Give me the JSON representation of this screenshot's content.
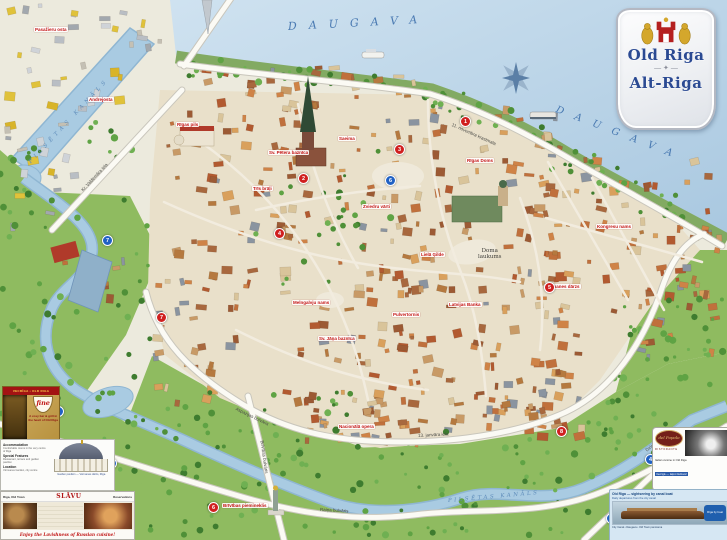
{
  "cartouche": {
    "title_en": "Old Riga",
    "title_de": "Alt-Riga",
    "ornament": "— ✦ —"
  },
  "water_labels": [
    {
      "name": "daugava-label-top",
      "text": "DAUGAVA",
      "x": 288,
      "y": 20,
      "rot": -3,
      "size": 11,
      "ls": 12,
      "color": "#4a7ab2"
    },
    {
      "name": "daugava-label-right",
      "text": "DAUGAVA",
      "x": 556,
      "y": 104,
      "rot": 21,
      "size": 10,
      "ls": 12,
      "color": "#4a7ab2"
    },
    {
      "name": "pilsetas-kanals-label-top",
      "text": "PILSĒTAS KANĀLS",
      "x": 30,
      "y": 160,
      "rot": -47,
      "size": 5.5,
      "ls": 4,
      "color": "#5e8cba"
    },
    {
      "name": "pilsetas-kanals-label-bottom",
      "text": "PILSĒTAS KANĀLS",
      "x": 448,
      "y": 498,
      "rot": -5,
      "size": 5.5,
      "ls": 2.5,
      "color": "#5e8cba"
    }
  ],
  "street_labels": [
    {
      "text": "11. novembra krastmala",
      "x": 452,
      "y": 122,
      "rot": 24
    },
    {
      "text": "Kr. Valdemāra iela",
      "x": 82,
      "y": 188,
      "rot": -47
    },
    {
      "text": "Brīvības bulvāris",
      "x": 262,
      "y": 438,
      "rot": 82
    },
    {
      "text": "Raiņa bulvāris",
      "x": 320,
      "y": 507,
      "rot": 3
    },
    {
      "text": "Aspazijas bulvāris",
      "x": 236,
      "y": 406,
      "rot": 26
    },
    {
      "text": "13. janvāra iela",
      "x": 418,
      "y": 433,
      "rot": -3
    },
    {
      "text": "Dzirnavu iela",
      "x": 646,
      "y": 448,
      "rot": -38
    }
  ],
  "place_labels": [
    {
      "text": "Doma\nlaukums",
      "x": 478,
      "y": 248,
      "size": 5.5
    }
  ],
  "landmark_labels": [
    {
      "text": "Pasažieru osta",
      "x": 34,
      "y": 27
    },
    {
      "text": "Andrejosta",
      "x": 88,
      "y": 97
    },
    {
      "text": "Rīgas pils",
      "x": 176,
      "y": 122
    },
    {
      "text": "Trīs brāļi",
      "x": 252,
      "y": 186
    },
    {
      "text": "Saeima",
      "x": 338,
      "y": 136
    },
    {
      "text": "Sv. Pētera baznīca",
      "x": 268,
      "y": 150
    },
    {
      "text": "Rīgas Doms",
      "x": 466,
      "y": 158
    },
    {
      "text": "Zviedru vārti",
      "x": 362,
      "y": 204
    },
    {
      "text": "Lielā Ģilde",
      "x": 420,
      "y": 252
    },
    {
      "text": "Pulvertornis",
      "x": 392,
      "y": 312
    },
    {
      "text": "Melngalvju nams",
      "x": 292,
      "y": 300
    },
    {
      "text": "Sv. Jāņa baznīca",
      "x": 318,
      "y": 336
    },
    {
      "text": "Nacionālā opera",
      "x": 338,
      "y": 424
    },
    {
      "text": "Brīvības piemineklis",
      "x": 222,
      "y": 503
    },
    {
      "text": "Latvijas Banka",
      "x": 448,
      "y": 302
    },
    {
      "text": "Vērmanes dārzs",
      "x": 544,
      "y": 284
    },
    {
      "text": "Kongresu nams",
      "x": 596,
      "y": 224
    }
  ],
  "markers": {
    "red": [
      {
        "n": "1",
        "x": 464,
        "y": 120
      },
      {
        "n": "2",
        "x": 302,
        "y": 177
      },
      {
        "n": "3",
        "x": 398,
        "y": 148
      },
      {
        "n": "4",
        "x": 278,
        "y": 232
      },
      {
        "n": "5",
        "x": 548,
        "y": 286
      },
      {
        "n": "6",
        "x": 212,
        "y": 506
      },
      {
        "n": "7",
        "x": 160,
        "y": 316
      },
      {
        "n": "8",
        "x": 560,
        "y": 430
      }
    ],
    "blue": [
      {
        "n": "1",
        "x": 57,
        "y": 410
      },
      {
        "n": "2",
        "x": 110,
        "y": 462
      },
      {
        "n": "3",
        "x": 108,
        "y": 514
      },
      {
        "n": "4",
        "x": 649,
        "y": 458
      },
      {
        "n": "5",
        "x": 610,
        "y": 517
      },
      {
        "n": "6",
        "x": 389,
        "y": 179
      },
      {
        "n": "7",
        "x": 106,
        "y": 239
      }
    ]
  },
  "ads": {
    "flyer": {
      "banner": "VECRĪGA • OLD RIGA",
      "logo": "fine",
      "text": "A cosy bar & grill in the heart of Old Riga"
    },
    "pavilion": {
      "sections": [
        {
          "h": "Accommodation",
          "t": "Comfortable rooms in the very centre of Riga"
        },
        {
          "h": "Special Features",
          "t": "Restaurant, terrace and garden pavilion"
        },
        {
          "h": "Location",
          "t": "Vērmanes Garden, city centre"
        }
      ],
      "caption": "Garden pavilion — Vērmanes dārzs, Rīga"
    },
    "banner": {
      "left": "Riga, Old Town",
      "logo": "SLĀVU",
      "right": "Reservations",
      "tagline": "Enjoy the Lavishness of Russian cuisine!"
    },
    "popolo": {
      "logo": "del Popolo",
      "sub": "RISTORANTE",
      "line1": "Italian cuisine in Old Riga",
      "line2": "Vecrīgā — laipni lūdzam!"
    },
    "boat": {
      "title": "Old Riga — sightseeing by canal boat",
      "sub": "Daily departures from the city canal",
      "badge": "Rīga by boat",
      "footer": "City Canal • Daugava • Old Town panorama"
    }
  }
}
